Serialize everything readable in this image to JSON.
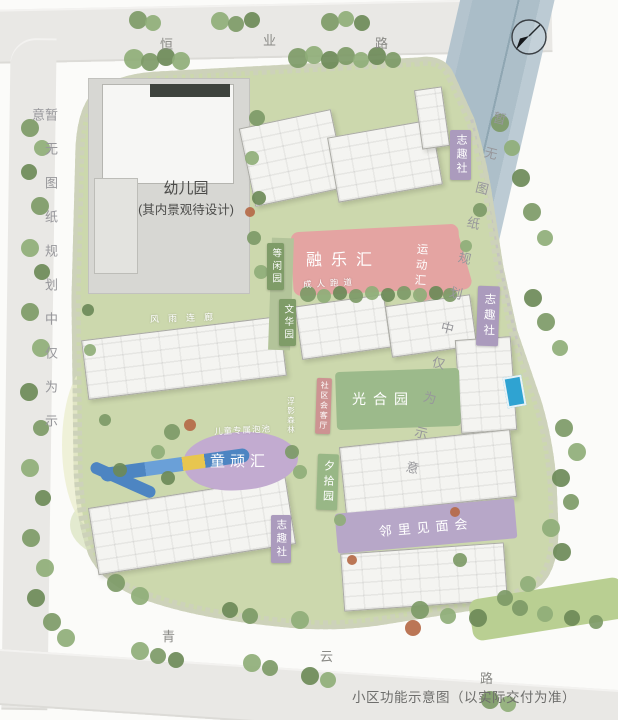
{
  "page": {
    "caption": "小区功能示意图（以实际交付为准）"
  },
  "roads": {
    "top_name": "恒业路",
    "top_chars": [
      "恒",
      "业",
      "路"
    ],
    "bottom_name": "青云路",
    "bottom_chars": [
      "青",
      "云",
      "路"
    ],
    "left_notice": "暂无图纸规划中仅为示意",
    "right_notice": "暂无图纸规划中仅为示意"
  },
  "compass": {
    "icon": "north-arrow"
  },
  "zones": {
    "kindergarten": {
      "label": "幼儿园",
      "sublabel": "(其内景观待设计)"
    },
    "ronglehui": {
      "label": "融乐汇",
      "color": "#e4a4a2"
    },
    "yundonghui": {
      "label": "运动汇"
    },
    "dengxianyuan": {
      "label": "等闲园",
      "color": "#7f9c68"
    },
    "chengrenpaodao": {
      "label": "成人跑道"
    },
    "wenhuayuan": {
      "label": "文华园",
      "color": "#7f9c68"
    },
    "fengyulianlang": {
      "label": "风雨连廊"
    },
    "zhiqushe_top": {
      "label": "志趣社",
      "color": "#ab9bbd"
    },
    "zhiqushe_right": {
      "label": "志趣社",
      "color": "#ab9bbd"
    },
    "zhiqushe_bottom": {
      "label": "志趣社",
      "color": "#ab9bbd"
    },
    "shequhuiketing": {
      "label": "社区会客厅",
      "color": "#cd9392"
    },
    "guangheyuan": {
      "label": "光合园",
      "color": "#9cba8b"
    },
    "fuyingsenlin": {
      "label": "浮影森林"
    },
    "tongwanhui": {
      "label": "童顽汇",
      "color": "#c2abd0"
    },
    "ertongpaochi": {
      "label": "儿童专属泡池"
    },
    "xishiyuan": {
      "label": "夕拾园",
      "color": "#98b786"
    },
    "linlijianmianhui": {
      "label": "邻里见面会",
      "color": "#b7a7c8"
    }
  },
  "colors": {
    "boundary_dash": "#c23b3b",
    "site_green": "#ccd8ad",
    "river": "#adbfc9",
    "road": "#e9e8e5"
  }
}
